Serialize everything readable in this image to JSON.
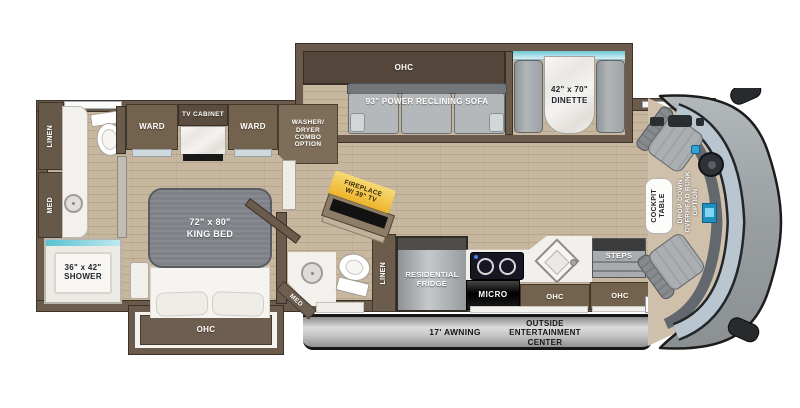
{
  "title": "Motorhome floor plan",
  "colors": {
    "wall": "#6a5b4c",
    "cabinet": "#73624e",
    "cabinet_dark": "#54463a",
    "floor": "#c8b79f",
    "accent_teal": "#6cc6d6",
    "fireplace_highlight": "#f2c254",
    "seat_gray": "#abafb2",
    "front_cap_gray": "#9aa0a3"
  },
  "bedroom": {
    "king_bed_size": "72\" x 80\"",
    "king_bed": "KING BED",
    "ohc": "OHC",
    "ward_left": "WARD",
    "ward_right": "WARD",
    "tv_cabinet": "TV CABINET"
  },
  "front_bath": {
    "linen": "LINEN",
    "med": "MED",
    "shower_size": "36\" x 42\"",
    "shower": "SHOWER"
  },
  "laundry": {
    "washer_line1": "WASHER/",
    "washer_line2": "DRYER",
    "washer_line3": "COMBO",
    "washer_line4": "OPTION"
  },
  "living": {
    "ohc": "OHC",
    "sofa": "93\" POWER RECLINING SOFA",
    "fireplace_line1": "FIREPLACE",
    "fireplace_line2": "W/ 39\" TV"
  },
  "dinette": {
    "size": "42\" x 70\"",
    "name": "DINETTE"
  },
  "mid_bath": {
    "med": "MED",
    "linen": "LINEN"
  },
  "kitchen": {
    "fridge_line1": "RESIDENTIAL",
    "fridge_line2": "FRIDGE",
    "micro": "MICRO",
    "ohc": "OHC"
  },
  "entry": {
    "steps": "STEPS",
    "ohc": "OHC"
  },
  "cockpit": {
    "table_line1": "COCKPIT",
    "table_line2": "TABLE",
    "bunk_line1": "DROP-DOWN",
    "bunk_line2": "OVERHEAD BUNK",
    "bunk_line3": "OPTION"
  },
  "exterior": {
    "awning": "17' AWNING",
    "entertainment_line1": "OUTSIDE",
    "entertainment_line2": "ENTERTAINMENT",
    "entertainment_line3": "CENTER"
  }
}
